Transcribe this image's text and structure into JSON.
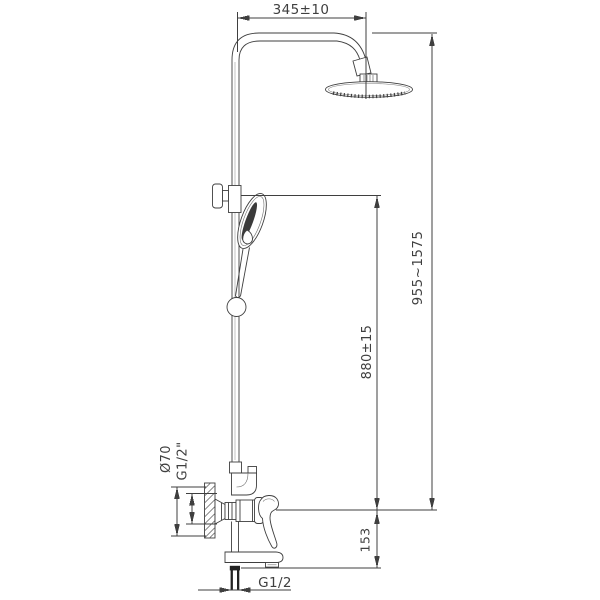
{
  "drawing": {
    "background": "#ffffff",
    "line_color": "#3f3f3f",
    "labels": {
      "top_width": "345±10",
      "overall_height": "955~1575",
      "bracket_height": "880±15",
      "spout_offset": "153",
      "escutcheon_diameter": "Ø70",
      "inlet_thread": "G1/2\"",
      "outlet_thread": "G1/2"
    }
  }
}
